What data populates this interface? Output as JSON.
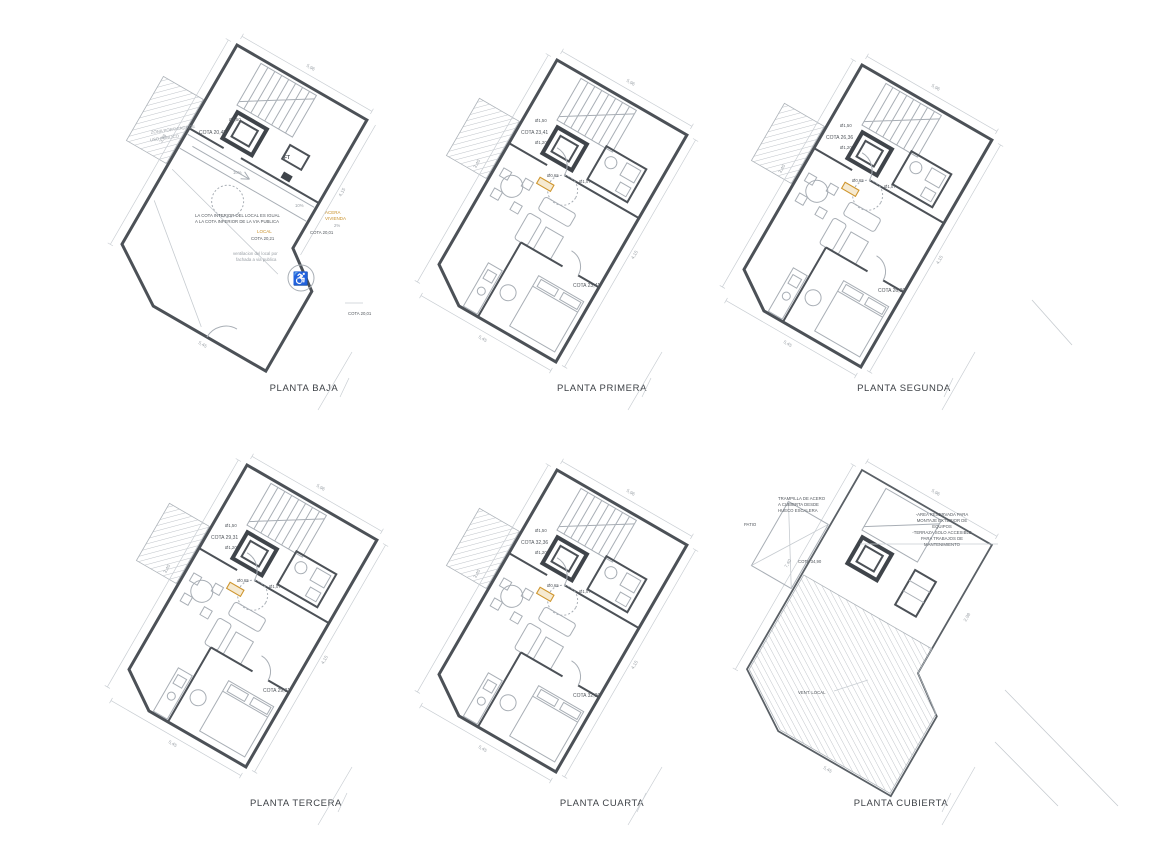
{
  "colors": {
    "wall": "#4c5157",
    "faint_line": "#a8aeb5",
    "dimension_line": "#c9ced3",
    "accent_orange": "#c9912a",
    "highlight_fill": "#f6ead1",
    "text": "#3e4247"
  },
  "plans": [
    {
      "id": "planta-baja",
      "label": "PLANTA BAJA",
      "cota_top": "COTA 20,45",
      "tag_unit": "Ø1,50",
      "tag_ft": "FT",
      "ramp1": "10%",
      "ramp2": "10%",
      "slope": "2%",
      "acera_1": "ACERA",
      "acera_2": "VIVIENDA",
      "acera_cota": "COTA 20,01",
      "local_label": "LOCAL",
      "local_cota": "COTA 20,21",
      "note_1": "LA COTA INTERIOR DEL LOCAL ES IGUAL",
      "note_2": "A LA COTA INFERIOR DE LA VIA PUBLICA",
      "porch_1": "ZONA PORTICADA DE",
      "porch_2": "USO PUBLICO",
      "vent_1": "ventilacion del local por",
      "vent_2": "fachada a via publica",
      "street_cota": "COTA 20,01",
      "dims": [
        "5,96",
        "3,98",
        "4,15",
        "5,45"
      ]
    },
    {
      "id": "planta-primera",
      "label": "PLANTA PRIMERA",
      "cota_top": "COTA 23,41",
      "cota_bottom": "COTA 23,41",
      "tags": [
        "Ø1,50",
        "Ø1,20",
        "Ø0,65",
        "Ø1,07"
      ],
      "dims": [
        "5,96",
        "3,40",
        "4,15",
        "5,45"
      ]
    },
    {
      "id": "planta-segunda",
      "label": "PLANTA SEGUNDA",
      "cota_top": "COTA 26,36",
      "cota_bottom": "COTA 26,36",
      "tags": [
        "Ø1,50",
        "Ø1,20",
        "Ø0,65",
        "Ø1,07"
      ],
      "dims": [
        "5,96",
        "3,40",
        "4,15",
        "5,45"
      ]
    },
    {
      "id": "planta-tercera",
      "label": "PLANTA TERCERA",
      "cota_top": "COTA 29,31",
      "cota_bottom": "COTA 29,31",
      "tags": [
        "Ø1,50",
        "Ø1,20",
        "Ø0,65",
        "Ø1,07"
      ],
      "dims": [
        "5,96",
        "3,40",
        "4,15",
        "5,45"
      ]
    },
    {
      "id": "planta-cuarta",
      "label": "PLANTA CUARTA",
      "cota_top": "COTA 32,36",
      "cota_bottom": "COTA 32,36",
      "tags": [
        "Ø1,50",
        "Ø1,20",
        "Ø0,65",
        "Ø1,07"
      ],
      "dims": [
        "5,96",
        "3,40",
        "4,15",
        "5,45"
      ]
    },
    {
      "id": "planta-cubierta",
      "label": "PLANTA  CUBIERTA",
      "cota": "COTA 34,90",
      "patio_label": "PATIO",
      "trap_1": "TRAMPILLA DE ACERO",
      "trap_2": "A CUBIERTA DESDE",
      "trap_3": "HUECO ESCALERA",
      "res_1": "-AREA RESERVADA PARA",
      "res_2": "MONTAJE EXTERIOR DE",
      "res_3": "EQUIPOS",
      "res_4": "-TERRAZA SOLO ACCESIBLE",
      "res_5": "PARA TRABAJOS DE",
      "res_6": "MANTENIMIENTO",
      "vent_label": "VENT. LOCAL",
      "dims": [
        "5,96",
        "7,40",
        "2,98",
        "5,45"
      ]
    }
  ]
}
